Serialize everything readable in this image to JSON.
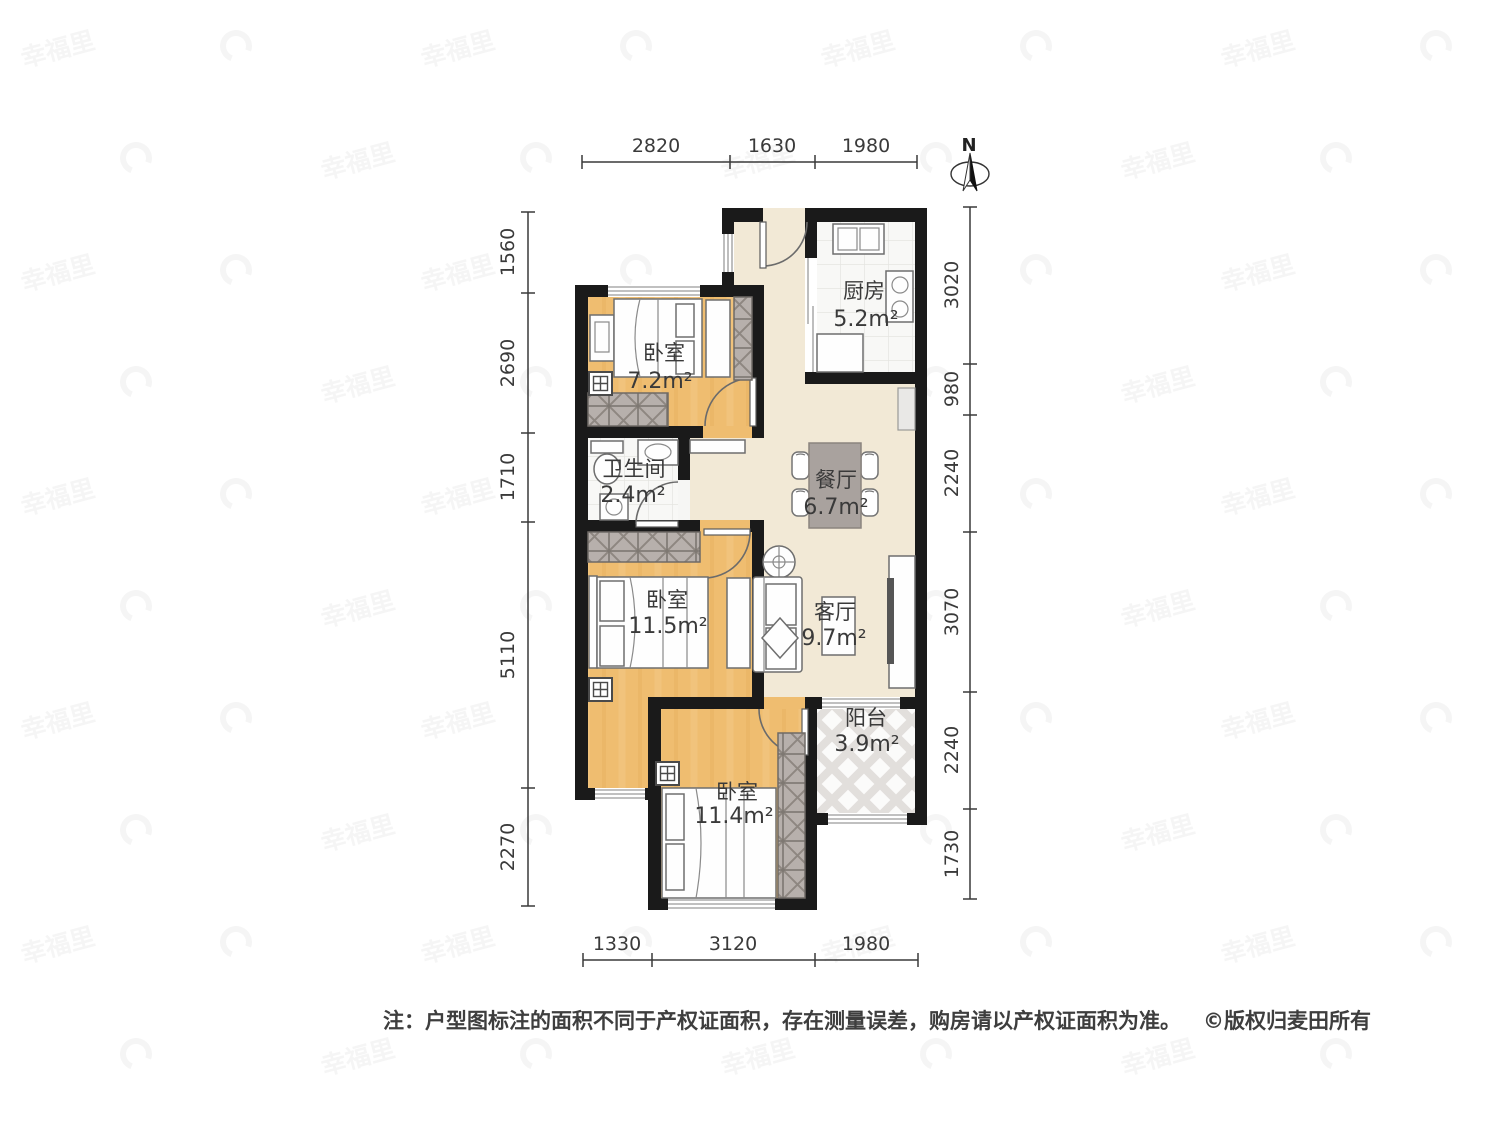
{
  "rooms": {
    "bedroom_top": {
      "label": "卧室",
      "area": "7.2m²"
    },
    "kitchen": {
      "label": "厨房",
      "area": "5.2m²"
    },
    "bathroom": {
      "label": "卫生间",
      "area": "2.4m²"
    },
    "dining": {
      "label": "餐厅",
      "area": "6.7m²"
    },
    "bedroom_middle": {
      "label": "卧室",
      "area": "11.5m²"
    },
    "living": {
      "label": "客厅",
      "area": "9.7m²"
    },
    "balcony": {
      "label": "阳台",
      "area": "3.9m²"
    },
    "bedroom_bottom": {
      "label": "卧室",
      "area": "11.4m²"
    }
  },
  "dimensions": {
    "top": [
      "2820",
      "1630",
      "1980"
    ],
    "bottom": [
      "1330",
      "3120",
      "1980"
    ],
    "left": [
      "1560",
      "2690",
      "1710",
      "5110",
      "2270"
    ],
    "right": [
      "3020",
      "980",
      "2240",
      "3070",
      "2240",
      "1730"
    ]
  },
  "compass": {
    "north_label": "N"
  },
  "footer": {
    "note": "注：户型图标注的面积不同于产权证面积，存在测量误差，购房请以产权证面积为准。",
    "copyright": "©版权归麦田所有"
  },
  "watermark": {
    "text": "幸福里"
  },
  "colors": {
    "wall": "#1a1a1a",
    "wood_floor": "#efbd70",
    "hall_floor": "#f2e9d6",
    "tile_floor": "#f8f8f6",
    "wardrobe": "#b7b0ac",
    "dining_table": "#a9a29e",
    "text": "#3a3a3a"
  }
}
